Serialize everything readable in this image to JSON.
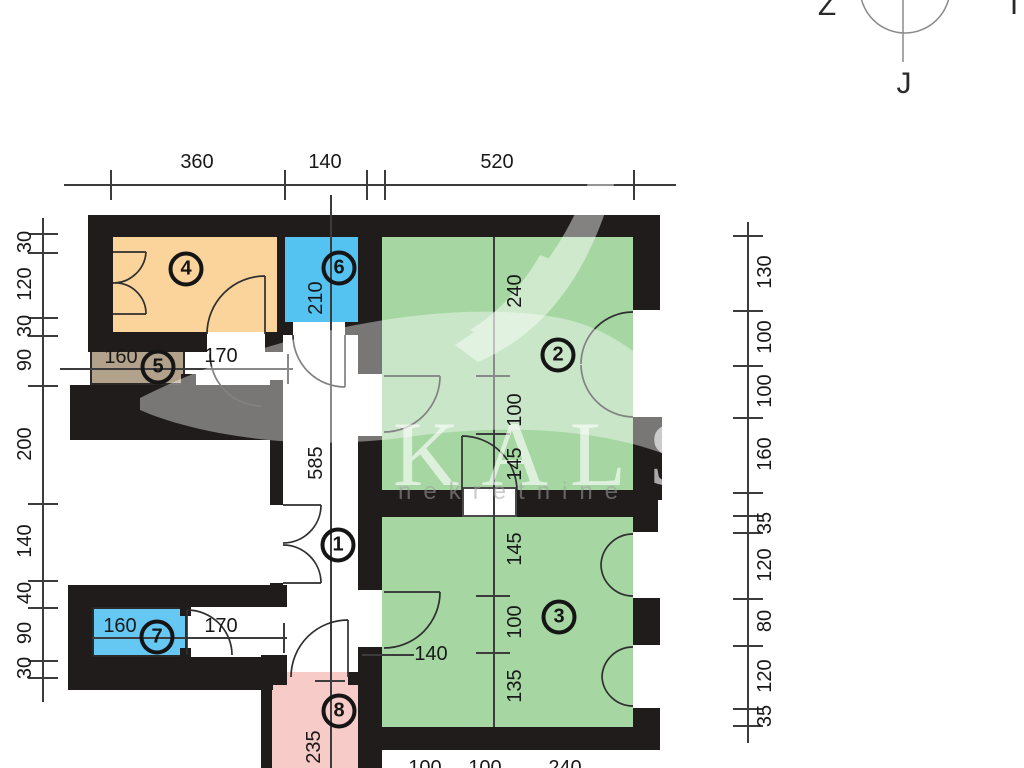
{
  "compass": {
    "west": "Z",
    "south": "J",
    "east": "I"
  },
  "watermark": {
    "brand": "KALS",
    "subtitle": "nekretnine"
  },
  "palette": {
    "wall": "#201c1b",
    "room_green": "#a6d7a3",
    "room_orange": "#fbd49c",
    "room_blue": "#55c3f1",
    "room_blue_light": "#65c8f3",
    "room_tan": "#b2a28b",
    "room_pink": "#f7cbc7"
  },
  "rooms": [
    {
      "id": "1"
    },
    {
      "id": "2"
    },
    {
      "id": "3"
    },
    {
      "id": "4"
    },
    {
      "id": "5"
    },
    {
      "id": "6"
    },
    {
      "id": "7"
    },
    {
      "id": "8"
    }
  ],
  "dims": {
    "top": [
      "360",
      "140",
      "520"
    ],
    "left": [
      "30",
      "120",
      "30",
      "90",
      "200",
      "140",
      "40",
      "90",
      "30"
    ],
    "right": [
      "130",
      "100",
      "100",
      "160",
      "35",
      "120",
      "80",
      "120",
      "35"
    ],
    "bottom": [
      "100",
      "100",
      "240"
    ],
    "hall_length": "585",
    "room6_depth": "210",
    "room8_depth": "235",
    "room2_column": [
      "240",
      "100",
      "145"
    ],
    "room3_column": [
      "145",
      "100",
      "135"
    ],
    "room5_width": "160",
    "door_vestibule": "170",
    "room7_width": "160",
    "door_corridor": "170",
    "room3_door": "140"
  }
}
